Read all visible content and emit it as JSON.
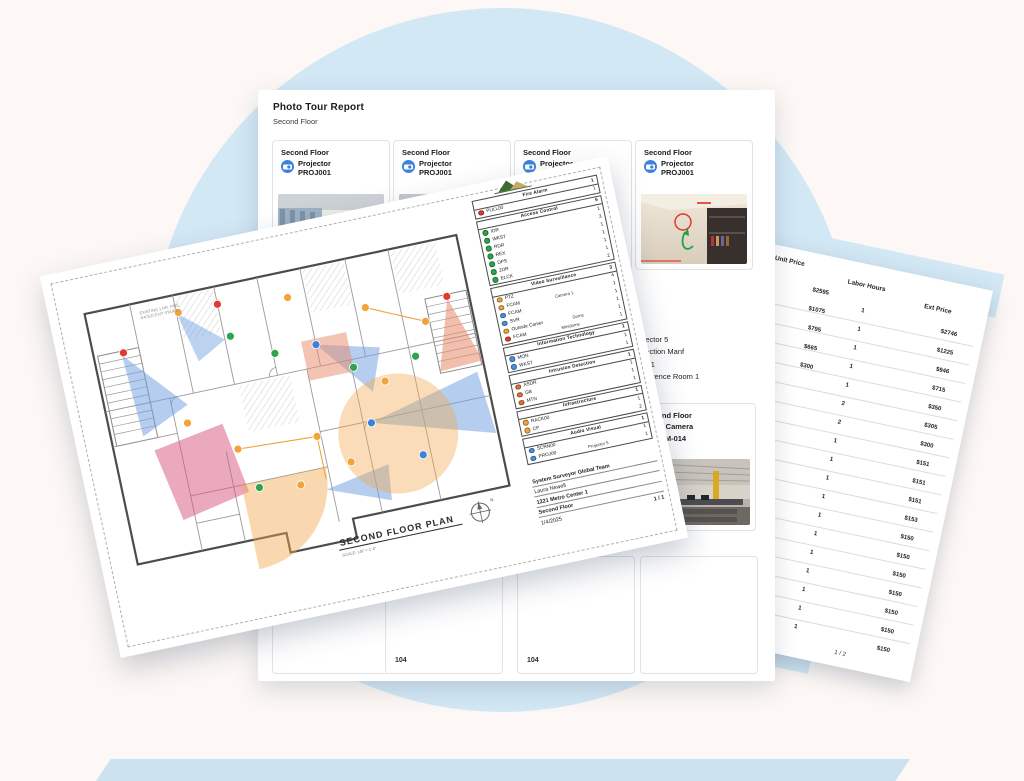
{
  "background": {
    "circle_color": "#d3e8f5",
    "bar_color": "#cde2f0"
  },
  "report": {
    "title": "Photo Tour Report",
    "subtitle": "Second Floor",
    "cards": [
      {
        "floor": "Second Floor",
        "device": "Projector",
        "device_id": "PROJ001"
      },
      {
        "floor": "Second Floor",
        "device": "Projector",
        "device_id": "PROJ001"
      },
      {
        "floor": "Second Floor",
        "device": "Projector",
        "device_id": "PROJ001"
      },
      {
        "floor": "Second Floor",
        "device": "Projector",
        "device_id": "PROJ001"
      }
    ],
    "detail_block": {
      "name": "Projector 5",
      "manufacturer": "Projection Manf",
      "model": "PC001",
      "location": "Conference Room 1"
    },
    "camera_card": {
      "floor": "Second Floor",
      "device": "Fixed Camera",
      "device_id": "SSCAM-014"
    },
    "room_labels": [
      "104",
      "104"
    ]
  },
  "plan": {
    "title": "SECOND FLOOR PLAN",
    "scale": "SCALE: 1/8\" = 1'-0\"",
    "stamp_line1": "EXISTING 1 HR. FIRE",
    "stamp_line2": "RATED EXIT STAIRS",
    "compass": "N",
    "legend": {
      "sections": [
        {
          "name": "Fire Alarm",
          "count": "1",
          "items": [
            {
              "label": "PULL00",
              "color": "#e23b2e",
              "note": "",
              "count": "1"
            }
          ]
        },
        {
          "name": "Access Control",
          "count": "5",
          "items": [
            {
              "label": "IDR",
              "color": "#2da44e",
              "note": "",
              "count": "1"
            },
            {
              "label": "WKST",
              "color": "#2da44e",
              "note": "",
              "count": "3"
            },
            {
              "label": "RDR",
              "color": "#2da44e",
              "note": "",
              "count": "1"
            },
            {
              "label": "REX",
              "color": "#2da44e",
              "note": "",
              "count": "1"
            },
            {
              "label": "DPS",
              "color": "#2da44e",
              "note": "",
              "count": "1"
            },
            {
              "label": "2DR",
              "color": "#2da44e",
              "note": "",
              "count": "1"
            },
            {
              "label": "ELCK",
              "color": "#2da44e",
              "note": "",
              "count": "2"
            }
          ]
        },
        {
          "name": "Video Surveillance",
          "count": "3",
          "items": [
            {
              "label": "PTZ",
              "color": "#f2a33c",
              "note": "",
              "count": "4"
            },
            {
              "label": "FCAM",
              "color": "#f2a33c",
              "note": "Camera 1",
              "count": "1"
            },
            {
              "label": "FCAM",
              "color": "#4f8fde",
              "note": "",
              "count": "1"
            },
            {
              "label": "SVR",
              "color": "#4f8fde",
              "note": "",
              "count": "1"
            },
            {
              "label": "Outside Camer",
              "color": "#f2a33c",
              "note": "Dome",
              "count": "1"
            },
            {
              "label": "FCAM",
              "color": "#e23b2e",
              "note": "Minidome",
              "count": "1"
            }
          ]
        },
        {
          "name": "Information Technology",
          "count": "1",
          "items": [
            {
              "label": "MON",
              "color": "#4f8fde",
              "note": "",
              "count": "1"
            },
            {
              "label": "WKST",
              "color": "#4f8fde",
              "note": "",
              "count": "1"
            }
          ]
        },
        {
          "name": "Intrusion Detection",
          "count": "1",
          "items": [
            {
              "label": "ASDR",
              "color": "#e2703a",
              "note": "",
              "count": "1"
            },
            {
              "label": "GB",
              "color": "#e2703a",
              "note": "",
              "count": "1"
            },
            {
              "label": "MTN",
              "color": "#e2703a",
              "note": "",
              "count": "1"
            }
          ]
        },
        {
          "name": "Infrastructure",
          "count": "1",
          "items": [
            {
              "label": "RACK00",
              "color": "#f2a33c",
              "note": "",
              "count": "1"
            },
            {
              "label": "CP",
              "color": "#f2a33c",
              "note": "",
              "count": "2"
            }
          ]
        },
        {
          "name": "Audio Visual",
          "count": "1",
          "items": [
            {
              "label": "SCRN00",
              "color": "#4f8fde",
              "note": "",
              "count": "1"
            },
            {
              "label": "PROJ00",
              "color": "#4f8fde",
              "note": "Projector 5",
              "count": "1"
            }
          ]
        }
      ]
    },
    "footer": {
      "company": "System Surveyor Global Team",
      "contact": "Laura Newell",
      "address": "1221 Metro Center 1",
      "floor": "Second Floor",
      "date": "1/4/2025",
      "page": "1 / 1"
    }
  },
  "pricing": {
    "headers": [
      "Unit Price",
      "Labor Hours",
      "Ext Price"
    ],
    "rows": [
      [
        "$2595",
        "1",
        "$2746"
      ],
      [
        "$1075",
        "1",
        "$1225"
      ],
      [
        "$795",
        "1",
        "$946"
      ],
      [
        "$665",
        "1",
        "$715"
      ],
      [
        "$300",
        "1",
        "$350"
      ],
      [
        "",
        "2",
        "$305"
      ],
      [
        "",
        "2",
        "$300"
      ],
      [
        "",
        "1",
        "$151"
      ],
      [
        "",
        "1",
        "$151"
      ],
      [
        "",
        "1",
        "$151"
      ],
      [
        "",
        "1",
        "$153"
      ],
      [
        "",
        "1",
        "$150"
      ],
      [
        "",
        "1",
        "$150"
      ],
      [
        "",
        "1",
        "$150"
      ],
      [
        "",
        "1",
        "$150"
      ],
      [
        "",
        "1",
        "$150"
      ],
      [
        "",
        "1",
        "$150"
      ],
      [
        "",
        "1",
        "$150"
      ]
    ],
    "page": "1 / 2"
  }
}
